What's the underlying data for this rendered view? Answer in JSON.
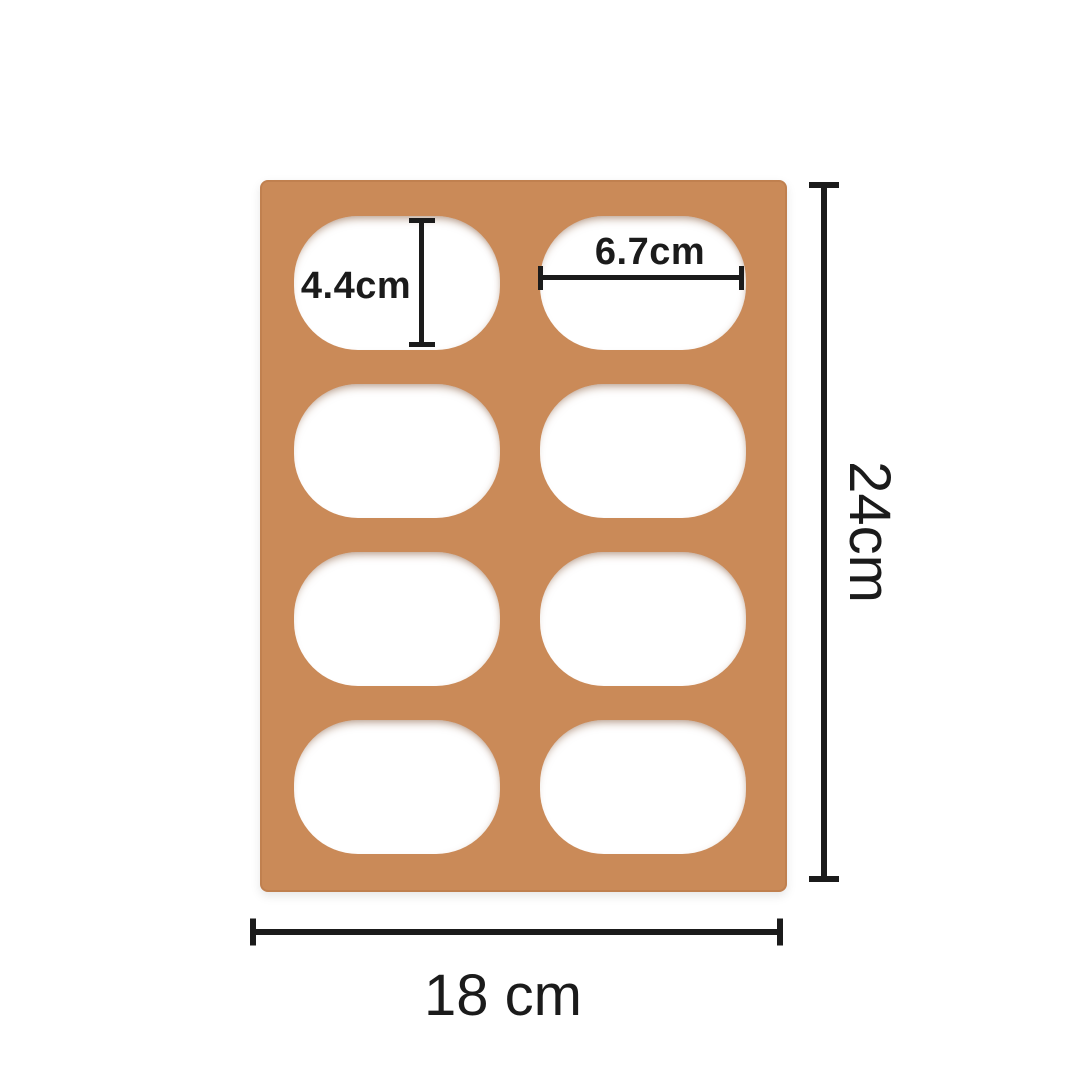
{
  "scene": {
    "type": "product-dimension-diagram",
    "subject": "Tan silicone mold mat with 8 rounded oval cavities arranged in 2 columns by 4 rows, annotated with size measurements",
    "background_color": "#ffffff"
  },
  "mat": {
    "color": "#ca8a58",
    "hole_color": "#ffffff",
    "columns": 2,
    "rows": 4,
    "hole_count": 8,
    "hole_shape": "rounded-oval"
  },
  "annotations": {
    "ink_color": "#1b1b1b",
    "hole_height": {
      "label": "4.4cm",
      "value": 4.4,
      "unit": "cm",
      "orientation": "vertical",
      "measures": "cavity height"
    },
    "hole_width": {
      "label": "6.7cm",
      "value": 6.7,
      "unit": "cm",
      "orientation": "horizontal",
      "measures": "cavity width"
    },
    "mat_height": {
      "label": "24cm",
      "value": 24,
      "unit": "cm",
      "orientation": "vertical",
      "measures": "overall mat height"
    },
    "mat_width": {
      "label": "18 cm",
      "value": 18,
      "unit": "cm",
      "orientation": "horizontal",
      "measures": "overall mat width"
    }
  }
}
